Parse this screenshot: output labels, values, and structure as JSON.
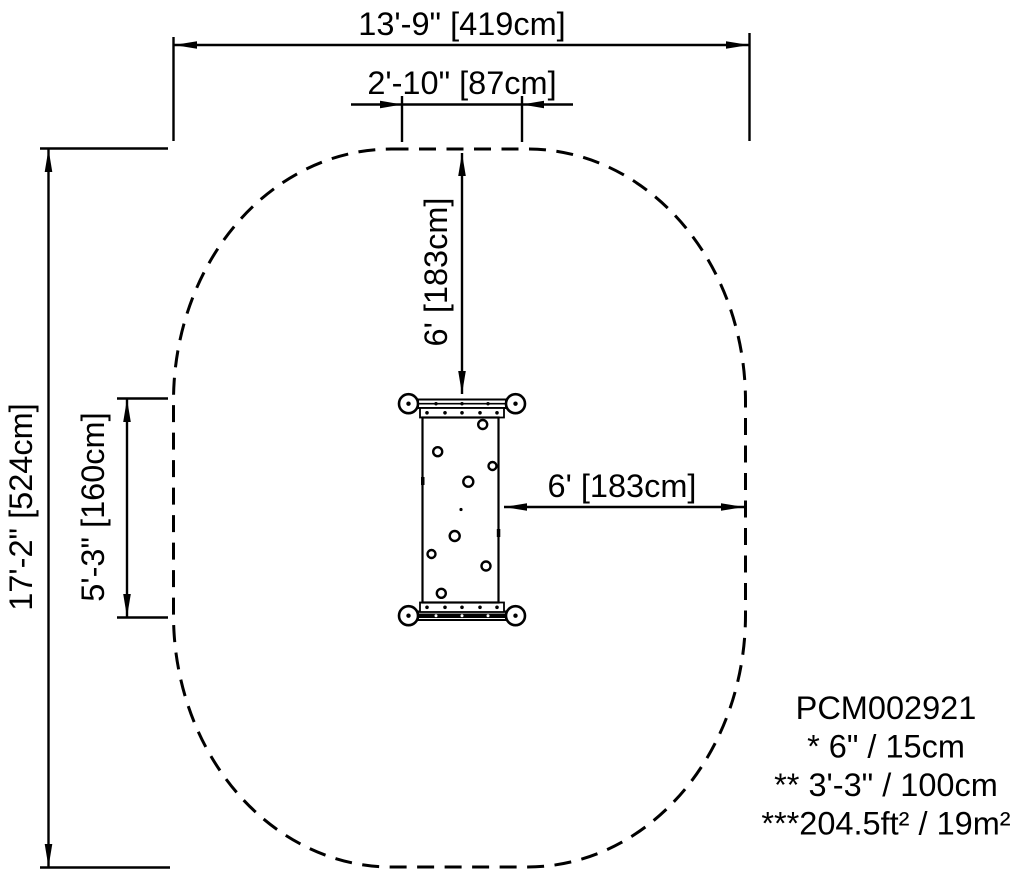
{
  "drawing": {
    "type": "playground equipment safety-zone plan view",
    "colors": {
      "line": "#000000",
      "background": "#ffffff"
    },
    "dimensions": {
      "overall_width": {
        "label": "13'-9\" [419cm]"
      },
      "inner_width": {
        "label": "2'-10\" [87cm]"
      },
      "overall_height": {
        "label": "17'-2\" [524cm]"
      },
      "equipment_length": {
        "label": "5'-3\" [160cm]"
      },
      "top_clearance": {
        "label": "6' [183cm]"
      },
      "right_clearance": {
        "label": "6' [183cm]"
      }
    },
    "legend": {
      "model_number": "PCM002921",
      "note1": "* 6\" / 15cm",
      "note2": "** 3'-3\" / 100cm",
      "note3": "***204.5ft² / 19m²"
    }
  }
}
